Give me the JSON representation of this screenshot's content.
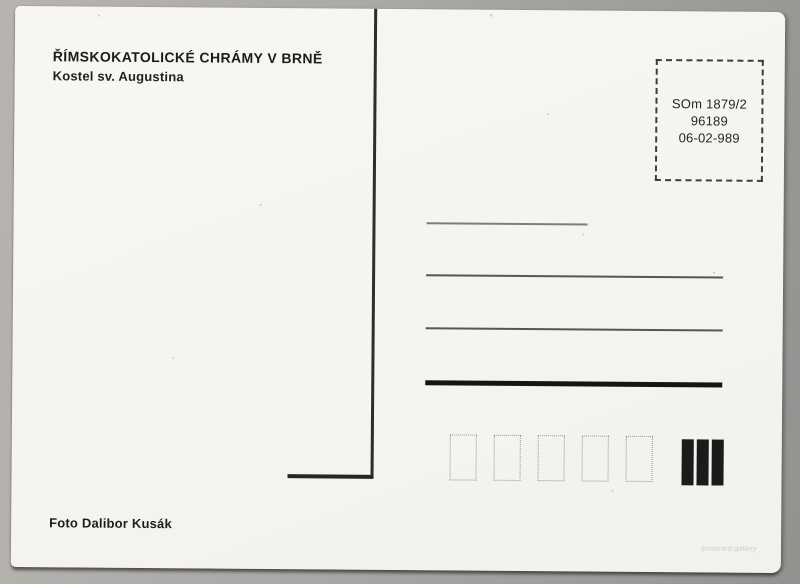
{
  "card": {
    "title": "ŘÍMSKOKATOLICKÉ CHRÁMY V BRNĚ",
    "subtitle": "Kostel sv. Augustina",
    "photo_credit": "Foto Dalibor Kusák",
    "watermark": "/postcard.gallery"
  },
  "stamp_box": {
    "lines": [
      "SOm 1879/2",
      "96189",
      "06-02-989"
    ]
  },
  "postal_boxes": {
    "count": 5
  },
  "barcode": {
    "bar_count": 3
  },
  "colors": {
    "scanner_background": "#aaa8a5",
    "card_background": "#f5f4f0",
    "ink": "#1c1c1c",
    "divider": "#2d2d2d",
    "address_line_light": "#7d7d7a",
    "address_line_dark": "#565653",
    "address_line_thick": "#151515",
    "postal_box_border": "#97978f",
    "watermark": "#cbcac6"
  }
}
